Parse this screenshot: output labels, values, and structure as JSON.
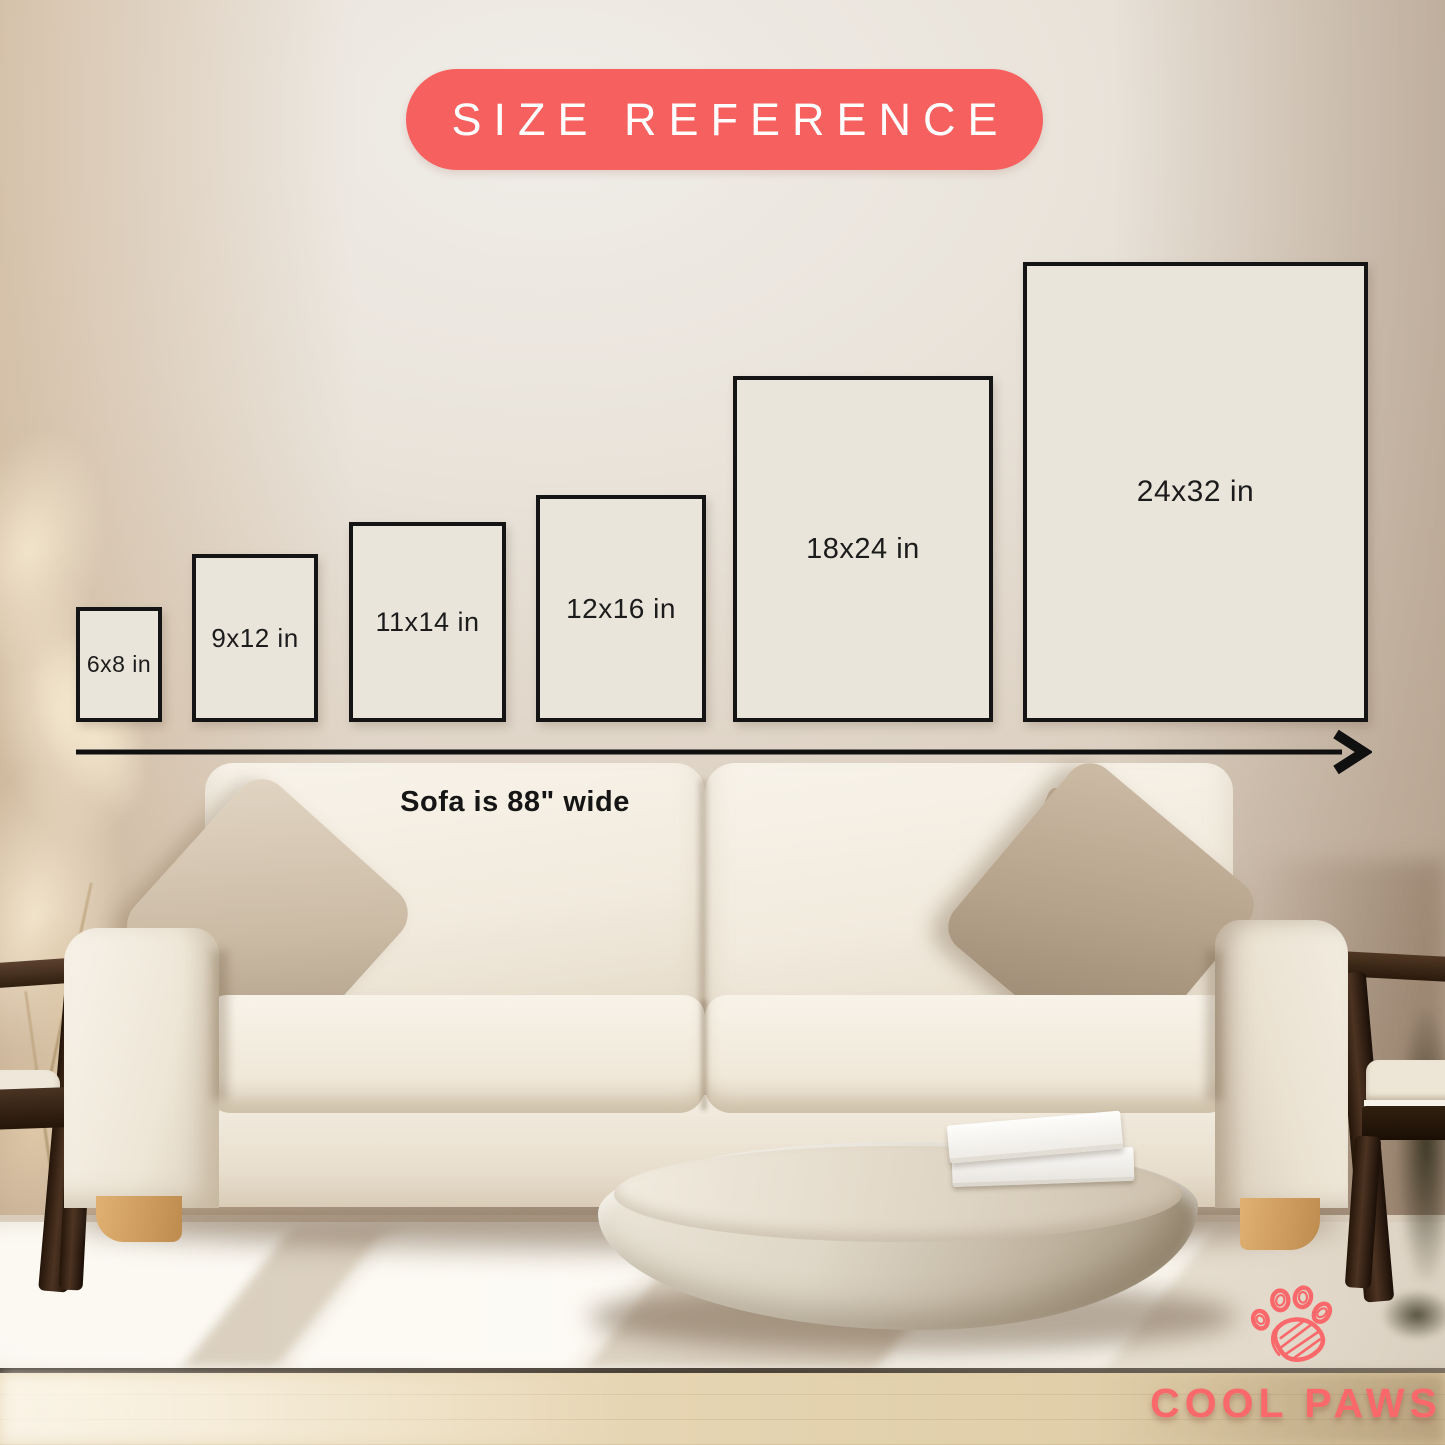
{
  "badge": {
    "label": "SIZE REFERENCE"
  },
  "frames_bottom": 722,
  "frames": [
    {
      "label": "6x8 in",
      "x": 76,
      "w": 86,
      "h": 115,
      "fs": 23
    },
    {
      "label": "9x12 in",
      "x": 192,
      "w": 126,
      "h": 168,
      "fs": 26
    },
    {
      "label": "11x14 in",
      "x": 349,
      "w": 157,
      "h": 200,
      "fs": 27
    },
    {
      "label": "12x16 in",
      "x": 536,
      "w": 170,
      "h": 227,
      "fs": 28
    },
    {
      "label": "18x24 in",
      "x": 733,
      "w": 260,
      "h": 346,
      "fs": 29
    },
    {
      "label": "24x32 in",
      "x": 1023,
      "w": 345,
      "h": 460,
      "fs": 30
    }
  ],
  "arrow": {
    "caption": "Sofa is 88\" wide"
  },
  "logo": {
    "text": "COOL PAWS",
    "icon": "paw-scribble-icon"
  },
  "colors": {
    "badge_bg": "#F66160",
    "badge_text": "#FFFFFF",
    "frame_fill": "#EAE5DA",
    "frame_border": "#141414",
    "label_text": "#1C1C1C",
    "arrow": "#101010",
    "logo": "#F9696B"
  }
}
